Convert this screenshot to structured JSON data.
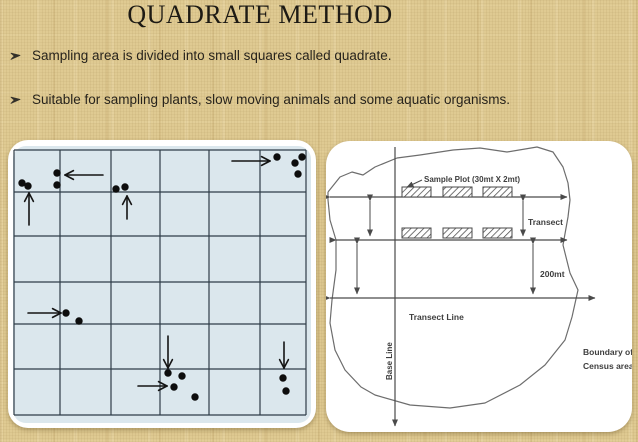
{
  "slide": {
    "title": "QUADRATE METHOD",
    "bullets": [
      {
        "text": "Sampling area is divided into small squares called quadrate."
      },
      {
        "text": "Suitable for sampling plants, slow moving animals and some aquatic organisms."
      }
    ]
  },
  "left_figure": {
    "description": "quadrat sampling grid with organism dots and pointer arrows",
    "grid": {
      "cols_x": [
        6,
        52,
        103,
        152,
        201,
        252,
        298
      ],
      "rows_y": [
        10,
        52,
        96,
        142,
        184,
        229,
        275
      ]
    },
    "dots": [
      [
        14,
        43
      ],
      [
        20,
        46
      ],
      [
        49,
        33
      ],
      [
        49,
        45
      ],
      [
        108,
        49
      ],
      [
        117,
        47
      ],
      [
        269,
        17
      ],
      [
        287,
        23
      ],
      [
        294,
        17
      ],
      [
        290,
        34
      ],
      [
        58,
        173
      ],
      [
        71,
        181
      ],
      [
        160,
        233
      ],
      [
        174,
        236
      ],
      [
        166,
        247
      ],
      [
        187,
        257
      ],
      [
        275,
        238
      ],
      [
        278,
        251
      ]
    ],
    "arrows": [
      {
        "x1": 21,
        "y1": 85,
        "x2": 21,
        "y2": 53
      },
      {
        "x1": 95,
        "y1": 35,
        "x2": 57,
        "y2": 35
      },
      {
        "x1": 119,
        "y1": 79,
        "x2": 119,
        "y2": 56
      },
      {
        "x1": 224,
        "y1": 21,
        "x2": 262,
        "y2": 21
      },
      {
        "x1": 20,
        "y1": 173,
        "x2": 53,
        "y2": 173
      },
      {
        "x1": 160,
        "y1": 196,
        "x2": 160,
        "y2": 228
      },
      {
        "x1": 130,
        "y1": 246,
        "x2": 159,
        "y2": 246
      },
      {
        "x1": 276,
        "y1": 202,
        "x2": 276,
        "y2": 228
      }
    ]
  },
  "right_figure": {
    "labels": {
      "sample_plot": "Sample Plot (30mt X 2mt)",
      "transect": "Transect",
      "distance": "200mt",
      "transect_line": "Transect Line",
      "base_line": "Base Line",
      "boundary_1": "Boundary of",
      "boundary_2": "Census area"
    }
  },
  "colors": {
    "background": "#dfca92",
    "panel": "#ffffff",
    "grid_bg": "#dbe7ed",
    "grid_line": "#2f3c48",
    "dot_ink": "#0d0d0d",
    "text_ink": "#27231c",
    "diagram_ink": "#4a4a4a"
  }
}
